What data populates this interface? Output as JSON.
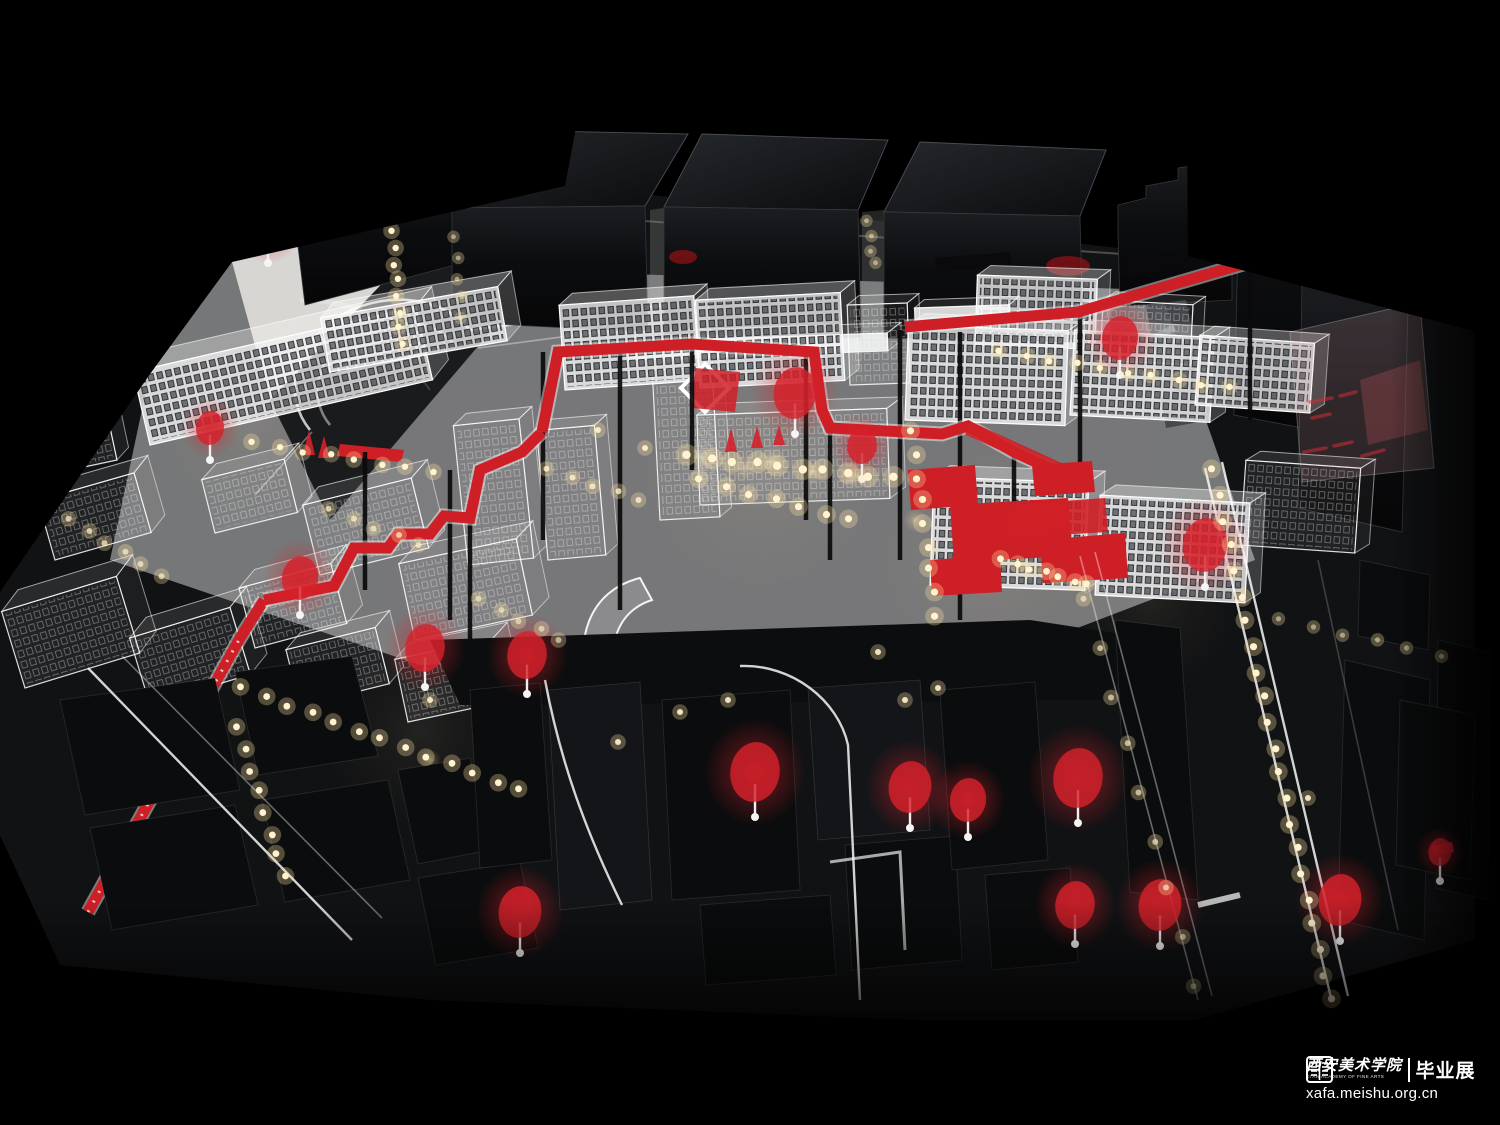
{
  "image": {
    "type": "photograph",
    "subject": "illuminated architectural scale model of an urban district: glossy black acrylic towers, translucent laser-etched white acrylic buildings, red elevated walkway, red translucent trees and warm LED street lights on a black base",
    "width_px": 1500,
    "height_px": 1125
  },
  "watermark": {
    "seal_icon": "academy-seal-icon",
    "academy_name_zh": "西安美术学院",
    "academy_name_en": "XI'AN ACADEMY OF FINE ARTS",
    "exhibition_label_zh": "毕业展",
    "website": "xafa.meishu.org.cn"
  },
  "palette": {
    "bg": "#000000",
    "gloss_black": "#101114",
    "matte_black": "#0b0c0d",
    "platform_white": "#d8d6d2",
    "ground_gray": "#232426",
    "acrylic_white": "#f2f2f4",
    "route_red": "#cf1f26",
    "tree_red": "#d6212b",
    "led_warm": "#ffe3a1"
  },
  "scene": {
    "back_row_black_buildings": 7,
    "acrylic_boxes": [
      [
        150,
        445,
        290,
        75,
        20,
        -16,
        -13,
        "etched"
      ],
      [
        330,
        372,
        180,
        55,
        16,
        -13,
        -10,
        "etched"
      ],
      [
        70,
        470,
        48,
        95,
        14,
        -10,
        -12,
        "wire"
      ],
      [
        25,
        688,
        120,
        80,
        22,
        -16,
        -17,
        "wire"
      ],
      [
        150,
        705,
        105,
        70,
        22,
        -15,
        -17,
        "wire"
      ],
      [
        255,
        648,
        95,
        62,
        20,
        -14,
        -15,
        "wire"
      ],
      [
        55,
        560,
        100,
        62,
        18,
        -13,
        -16,
        "wire"
      ],
      [
        215,
        533,
        85,
        55,
        18,
        -12,
        -14,
        "wire"
      ],
      [
        320,
        575,
        112,
        72,
        20,
        -14,
        -14,
        "wire"
      ],
      [
        415,
        640,
        120,
        78,
        20,
        -14,
        -12,
        "wire"
      ],
      [
        300,
        706,
        92,
        58,
        18,
        -13,
        -14,
        "wire"
      ],
      [
        408,
        722,
        100,
        64,
        18,
        -13,
        -12,
        "wire"
      ],
      [
        468,
        565,
        66,
        140,
        14,
        -11,
        -6,
        "wire"
      ],
      [
        548,
        560,
        58,
        130,
        13,
        -10,
        -5,
        "wire"
      ],
      [
        628,
        360,
        260,
        18,
        14,
        -10,
        -2,
        "solid"
      ],
      [
        660,
        520,
        60,
        150,
        12,
        -9,
        -3,
        "wire"
      ],
      [
        700,
        505,
        190,
        90,
        16,
        -11,
        -2,
        "wire"
      ],
      [
        565,
        390,
        135,
        85,
        14,
        -11,
        -4,
        "etched"
      ],
      [
        700,
        388,
        145,
        88,
        15,
        -11,
        -3,
        "etched"
      ],
      [
        850,
        385,
        60,
        80,
        12,
        -9,
        -2,
        "wire"
      ],
      [
        975,
        345,
        120,
        70,
        13,
        -10,
        2,
        "etched"
      ],
      [
        1100,
        360,
        90,
        60,
        12,
        -9,
        3,
        "wire"
      ],
      [
        905,
        420,
        160,
        95,
        16,
        -12,
        2,
        "etched"
      ],
      [
        1070,
        415,
        140,
        85,
        15,
        -11,
        3,
        "etched"
      ],
      [
        1195,
        405,
        115,
        70,
        14,
        -10,
        4,
        "etched"
      ],
      [
        930,
        585,
        155,
        108,
        16,
        -12,
        2,
        "etched"
      ],
      [
        1095,
        595,
        150,
        100,
        15,
        -11,
        3,
        "etched"
      ],
      [
        1240,
        545,
        115,
        85,
        14,
        -10,
        4,
        "wire"
      ],
      [
        915,
        322,
        95,
        14,
        10,
        -8,
        -2,
        "solid"
      ]
    ],
    "red_trees": [
      [
        268,
        228,
        20
      ],
      [
        210,
        428,
        17
      ],
      [
        300,
        578,
        22
      ],
      [
        425,
        648,
        24
      ],
      [
        527,
        655,
        24
      ],
      [
        795,
        393,
        26
      ],
      [
        862,
        446,
        18
      ],
      [
        1120,
        338,
        22
      ],
      [
        1205,
        545,
        27
      ],
      [
        755,
        772,
        30
      ],
      [
        1078,
        778,
        30
      ],
      [
        520,
        912,
        26
      ],
      [
        910,
        787,
        26
      ],
      [
        968,
        800,
        22
      ],
      [
        1075,
        905,
        24
      ],
      [
        1160,
        905,
        26
      ],
      [
        1340,
        900,
        26
      ],
      [
        1440,
        852,
        14
      ]
    ],
    "led_strings": [
      [
        393,
        232,
        401,
        344,
        8,
        3.2,
        1
      ],
      [
        253,
        443,
        432,
        472,
        8,
        3.2,
        1
      ],
      [
        242,
        688,
        520,
        790,
        13,
        3.4,
        1
      ],
      [
        238,
        728,
        284,
        876,
        8,
        3.4,
        1
      ],
      [
        688,
        456,
        892,
        478,
        10,
        4.2,
        1
      ],
      [
        700,
        480,
        850,
        520,
        7,
        3.6,
        1
      ],
      [
        912,
        432,
        936,
        615,
        9,
        3.6,
        1
      ],
      [
        1000,
        352,
        1228,
        388,
        10,
        3.2,
        1
      ],
      [
        1002,
        560,
        1088,
        585,
        7,
        3.4,
        1
      ],
      [
        1213,
        470,
        1330,
        1000,
        22,
        3.6,
        1
      ],
      [
        1085,
        600,
        1195,
        985,
        9,
        3,
        0.65
      ],
      [
        455,
        238,
        462,
        318,
        5,
        2.4,
        0.5
      ],
      [
        868,
        222,
        874,
        264,
        4,
        2.4,
        0.5
      ],
      [
        548,
        470,
        640,
        500,
        5,
        3,
        0.8
      ],
      [
        70,
        520,
        160,
        575,
        6,
        3,
        0.7
      ],
      [
        330,
        510,
        420,
        545,
        5,
        3,
        0.7
      ],
      [
        480,
        600,
        560,
        640,
        5,
        3,
        0.6
      ],
      [
        1280,
        620,
        1440,
        655,
        6,
        2.6,
        0.5
      ]
    ],
    "led_singles": [
      [
        680,
        712
      ],
      [
        728,
        700
      ],
      [
        905,
        700
      ],
      [
        938,
        688
      ],
      [
        878,
        652
      ],
      [
        1308,
        798
      ],
      [
        618,
        742
      ],
      [
        430,
        700
      ],
      [
        598,
        430
      ],
      [
        645,
        448
      ]
    ],
    "ground_glows": [
      [
        760,
        470,
        120,
        0.1
      ],
      [
        420,
        730,
        100,
        0.08
      ],
      [
        990,
        560,
        110,
        0.1
      ],
      [
        250,
        420,
        90,
        0.08
      ],
      [
        1150,
        600,
        90,
        0.08
      ],
      [
        700,
        458,
        14,
        0.5
      ],
      [
        745,
        468,
        13,
        0.5
      ],
      [
        772,
        462,
        15,
        0.55
      ],
      [
        812,
        472,
        13,
        0.5
      ],
      [
        852,
        476,
        14,
        0.5
      ],
      [
        915,
        520,
        12,
        0.45
      ],
      [
        960,
        540,
        12,
        0.45
      ],
      [
        1060,
        640,
        12,
        0.4
      ],
      [
        260,
        700,
        11,
        0.4
      ],
      [
        430,
        760,
        11,
        0.4
      ],
      [
        520,
        800,
        12,
        0.4
      ]
    ],
    "support_poles": [
      [
        543,
        352,
        540
      ],
      [
        620,
        344,
        610
      ],
      [
        692,
        344,
        470
      ],
      [
        806,
        352,
        520
      ],
      [
        900,
        330,
        560
      ],
      [
        960,
        332,
        620
      ],
      [
        1080,
        312,
        470
      ],
      [
        1250,
        262,
        420
      ],
      [
        450,
        470,
        620
      ],
      [
        365,
        452,
        590
      ],
      [
        470,
        518,
        640
      ],
      [
        830,
        428,
        560
      ],
      [
        1014,
        452,
        560
      ]
    ]
  }
}
